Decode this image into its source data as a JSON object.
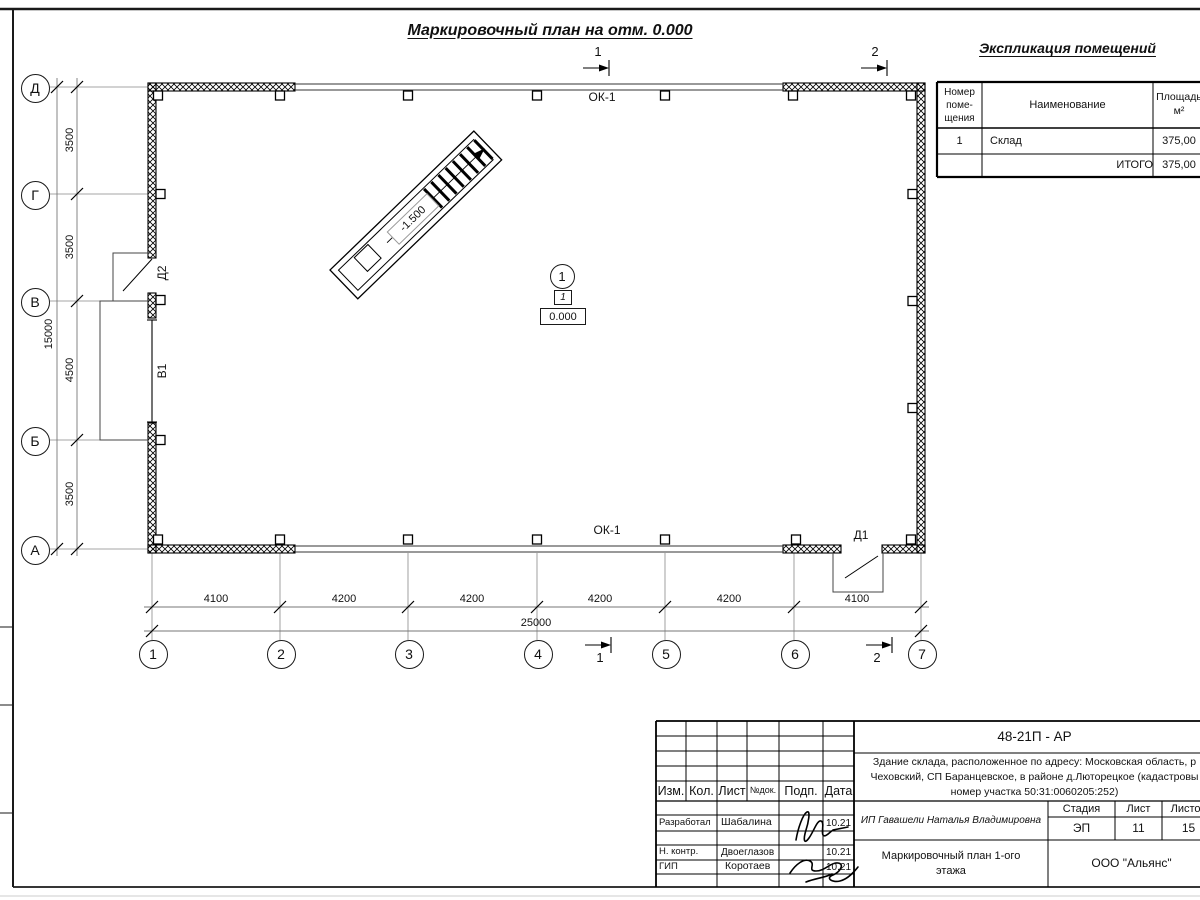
{
  "sheet_title": "Маркировочный план на отм. 0.000",
  "explication": {
    "title": "Экспликация помещений",
    "columns": {
      "number": "Номер\nпоме-\nщения",
      "name": "Наименование",
      "area": "Площадь\nм²"
    },
    "rows": [
      {
        "number": "1",
        "name": "Склад",
        "area": "375,00"
      },
      {
        "number": "",
        "name": "ИТОГО",
        "area": "375,00"
      }
    ]
  },
  "plan": {
    "axes_letters": [
      "Д",
      "Г",
      "В",
      "Б",
      "А"
    ],
    "axes_numbers": [
      "1",
      "2",
      "3",
      "4",
      "5",
      "6",
      "7"
    ],
    "dims_left": [
      "3500",
      "3500",
      "4500",
      "3500"
    ],
    "total_left": "15000",
    "dims_bottom": [
      "4100",
      "4200",
      "4200",
      "4200",
      "4200",
      "4100"
    ],
    "total_bottom": "25000",
    "window_mark_top": "ОК-1",
    "window_mark_bottom": "ОК-1",
    "door_mark_1": "Д1",
    "door_mark_2": "Д2",
    "gate_mark": "В1",
    "ramp_level": "-1.500",
    "room_number": "1",
    "room_type_tag": "1",
    "floor_level": "0.000",
    "section_mark_1": "1",
    "section_mark_2": "2"
  },
  "titleblock": {
    "doc_number": "48-21П - АР",
    "description": "Здание склада, расположенное по адресу: Московская область, р\nЧеховский, СП Баранцевское, в районе д.Люторецкое (кадастровы\nномер участка 50:31:0060205:252)",
    "columns": {
      "izm": "Изм.",
      "kol": "Кол.",
      "list": "Лист",
      "ndok": "№док.",
      "podp": "Подп.",
      "data": "Дата"
    },
    "rows": [
      {
        "role": "Разработал",
        "name": "Шабалина",
        "date": "10.21"
      },
      {
        "role": "Н. контр.",
        "name": "Двоеглазов",
        "date": "10.21"
      },
      {
        "role": "ГИП",
        "name": "Коротаев",
        "date": "10.21"
      }
    ],
    "client": "ИП Гавашели Наталья Владимировна",
    "stage_label": "Стадия",
    "sheet_label": "Лист",
    "sheets_label": "Листов",
    "stage": "ЭП",
    "sheet_number": "11",
    "sheets_total": "15",
    "doc_title": "Маркировочный план 1-ого\nэтажа",
    "company": "ООО \"Альянс\""
  },
  "colors": {
    "ink": "#111111",
    "thin_line": "#777777",
    "paper": "#ffffff"
  }
}
